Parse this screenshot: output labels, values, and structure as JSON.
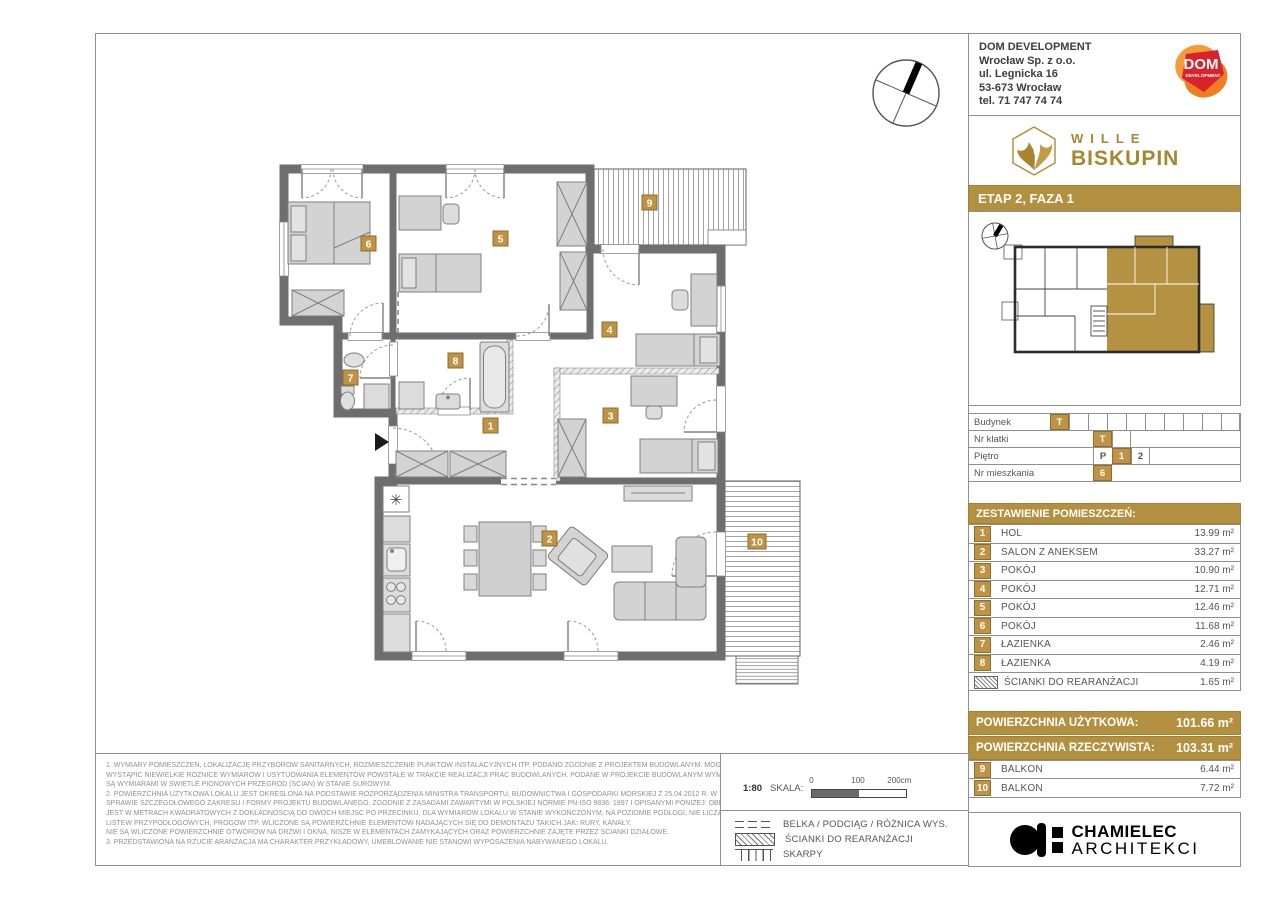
{
  "company": {
    "name": "DOM DEVELOPMENT",
    "addr1": "Wrocław Sp. z o.o.",
    "addr2": "ul. Legnicka 16",
    "addr3": "53-673  Wrocław",
    "addr4": "tel. 71 747 74 74",
    "logo_text": "DOM",
    "logo_sub": "DEVELOPMENT"
  },
  "brand": {
    "line1": "WILLE",
    "line2": "BISKUPIN"
  },
  "stage": "ETAP 2, FAZA 1",
  "unit_info": {
    "rows": [
      {
        "label": "Budynek",
        "cells": [
          "T",
          "",
          "",
          "",
          "",
          "",
          "",
          "",
          "",
          ""
        ]
      },
      {
        "label": "Nr klatki",
        "cells": [
          "T",
          ""
        ]
      },
      {
        "label": "Piętro",
        "cells": [
          "P",
          "1",
          "2"
        ]
      },
      {
        "label": "Nr mieszkania",
        "cells": [
          "6"
        ]
      }
    ]
  },
  "rooms_header": "ZESTAWIENIE POMIESZCZEŃ:",
  "rooms": [
    {
      "num": "1",
      "name": "HOL",
      "area": "13.99 m²"
    },
    {
      "num": "2",
      "name": "SALON Z ANEKSEM",
      "area": "33.27 m²"
    },
    {
      "num": "3",
      "name": "POKÓJ",
      "area": "10.90 m²"
    },
    {
      "num": "4",
      "name": "POKÓJ",
      "area": "12.71 m²"
    },
    {
      "num": "5",
      "name": "POKÓJ",
      "area": "12.46 m²"
    },
    {
      "num": "6",
      "name": "POKÓJ",
      "area": "11.68 m²"
    },
    {
      "num": "7",
      "name": "ŁAZIENKA",
      "area": "2.46 m²"
    },
    {
      "num": "8",
      "name": "ŁAZIENKA",
      "area": "4.19 m²"
    }
  ],
  "rearrangement": {
    "name": "ŚCIANKI DO REARANŻACJI",
    "area": "1.65 m²"
  },
  "area_summary": [
    {
      "label": "POWIERZCHNIA UŻYTKOWA:",
      "value": "101.66 m²"
    },
    {
      "label": "POWIERZCHNIA RZECZYWISTA:",
      "value": "103.31 m²"
    }
  ],
  "balconies": [
    {
      "num": "9",
      "name": "BALKON",
      "area": "6.44 m²"
    },
    {
      "num": "10",
      "name": "BALKON",
      "area": "7.72 m²"
    }
  ],
  "scale": {
    "ratio": "1:80",
    "label": "SKALA:",
    "tick0": "0",
    "tick1": "100",
    "tick2": "200cm"
  },
  "legend": [
    {
      "label": "BELKA / PODCIĄG / RÓŻNICA WYS."
    },
    {
      "label": "ŚCIANKI DO REARANŻACJI"
    },
    {
      "label": "SKARPY"
    }
  ],
  "architect": {
    "name": "CHAMIELEC",
    "sub": "ARCHITEKCI"
  },
  "disclaimer": {
    "lines": [
      "1. WYMIARY POMIESZCZEŃ, LOKALIZACJĘ PRZYBORÓW SANITARNYCH, ROZMIESZCZENIE PUNKTÓW INSTALACYJNYCH ITP. PODANO ZGODNIE Z PROJEKTEM BUDOWLANYM. MOGĄ",
      "WYSTĄPIĆ NIEWIELKIE RÓŻNICE WYMIARÓW I USYTUOWANIA ELEMENTÓW POWSTAŁE W TRAKCIE REALIZACJI PRAC BUDOWLANYCH. PODANE W PROJEKCIE BUDOWLANYM WYMIARY",
      "SĄ WYMIARAMI W ŚWIETLE PIONOWYCH PRZEGRÓD (ŚCIAN) W STANIE SUROWYM.",
      "2. POWIERZCHNIA UŻYTKOWA LOKALU JEST OKREŚLONA NA PODSTAWIE ROZPORZĄDZENIA MINISTRA TRANSPORTU, BUDOWNICTWA I GOSPODARKI MORSKIEJ Z 25.04.2012 R. W",
      "SPRAWIE SZCZEGÓŁOWEGO ZAKRESU I FORMY PROJEKTU BUDOWLANEGO, ZGODNIE Z ZASADAMI ZAWARTYMI W POLSKIEJ NORMIE PN-ISO 9836: 1997 I OPISANYMI PONIŻEJ: OBLICZONA",
      "JEST W METRACH KWADRATOWYCH Z DOKŁADNOŚCIĄ DO DWÓCH MIEJSC PO PRZECINKU, DLA WYMIARÓW LOKALU W STANIE WYKOŃCZONYM, NA POZIOMIE PODŁOGI, NIE LICZĄC",
      "LISTEW PRZYPODŁOGOWYCH, PROGÓW ITP. WLICZONE SĄ POWIERZCHNIE ELEMENTÓW NADAJĄCYCH SIĘ DO DEMONTAŻU TAKICH JAK: RURY, KANAŁY.",
      "NIE SĄ WLICZONE POWIERZCHNIE OTWORÓW NA DRZWI I OKNA, NISZE W ELEMENTACH ZAMYKAJĄCYCH ORAZ POWIERZCHNIE ZAJĘTE PRZEZ ŚCIANKI DZIAŁOWE.",
      "3. PRZEDSTAWIONA NA RZUCIE ARANŻACJA MA CHARAKTER PRZYKŁADOWY, UMEBLOWANIE NIE STANOWI WYPOSAŻENIA NABYWANEGO LOKALU."
    ]
  },
  "colors": {
    "gold": "#b3903f",
    "badge_gold": "#bf9343",
    "wall_gray": "#6e6e6e",
    "dom_red": "#d8232a",
    "dom_orange": "#f0832a"
  }
}
